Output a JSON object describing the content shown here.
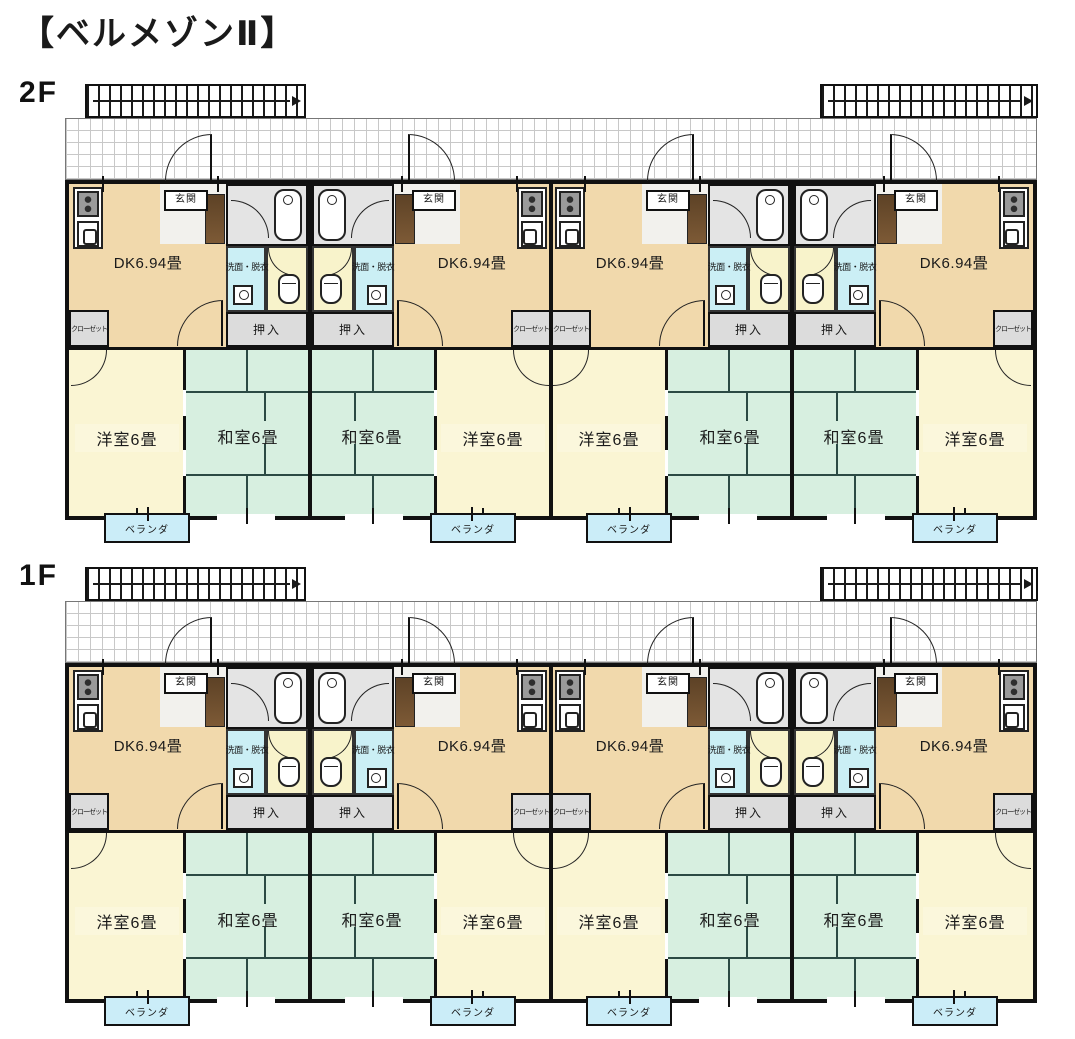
{
  "title": "【ベルメゾンⅡ】",
  "colors": {
    "dk_room": "#F1D9AC",
    "western_room": "#FAF5D3",
    "japanese_room": "#D7EFE0",
    "veranda": "#CBEDF8",
    "closet": "#DCDCDC",
    "bath": "#E4E4E4",
    "toilet_room": "#F8F3CB",
    "washroom": "#CBEFF5",
    "shoe_cabinet": "#7d5a36",
    "walls": "#111111"
  },
  "floors": [
    {
      "label": "2F",
      "units": [
        {
          "mirrored": false,
          "dk": "DK6.94畳",
          "entrance": "玄関",
          "washroom": "洗面・脱衣",
          "oshiire": "押入",
          "closet": "クローゼット",
          "western_room": "洋室6畳",
          "japanese_room": "和室6畳",
          "veranda": "ベランダ"
        },
        {
          "mirrored": true,
          "dk": "DK6.94畳",
          "entrance": "玄関",
          "washroom": "洗面・脱衣",
          "oshiire": "押入",
          "closet": "クローゼット",
          "western_room": "洋室6畳",
          "japanese_room": "和室6畳",
          "veranda": "ベランダ"
        },
        {
          "mirrored": false,
          "dk": "DK6.94畳",
          "entrance": "玄関",
          "washroom": "洗面・脱衣",
          "oshiire": "押入",
          "closet": "クローゼット",
          "western_room": "洋室6畳",
          "japanese_room": "和室6畳",
          "veranda": "ベランダ"
        },
        {
          "mirrored": true,
          "dk": "DK6.94畳",
          "entrance": "玄関",
          "washroom": "洗面・脱衣",
          "oshiire": "押入",
          "closet": "クローゼット",
          "western_room": "洋室6畳",
          "japanese_room": "和室6畳",
          "veranda": "ベランダ"
        }
      ]
    },
    {
      "label": "1F",
      "units": [
        {
          "mirrored": false,
          "dk": "DK6.94畳",
          "entrance": "玄関",
          "washroom": "洗面・脱衣",
          "oshiire": "押入",
          "closet": "クローゼット",
          "western_room": "洋室6畳",
          "japanese_room": "和室6畳",
          "veranda": "ベランダ"
        },
        {
          "mirrored": true,
          "dk": "DK6.94畳",
          "entrance": "玄関",
          "washroom": "洗面・脱衣",
          "oshiire": "押入",
          "closet": "クローゼット",
          "western_room": "洋室6畳",
          "japanese_room": "和室6畳",
          "veranda": "ベランダ"
        },
        {
          "mirrored": false,
          "dk": "DK6.94畳",
          "entrance": "玄関",
          "washroom": "洗面・脱衣",
          "oshiire": "押入",
          "closet": "クローゼット",
          "western_room": "洋室6畳",
          "japanese_room": "和室6畳",
          "veranda": "ベランダ"
        },
        {
          "mirrored": true,
          "dk": "DK6.94畳",
          "entrance": "玄関",
          "washroom": "洗面・脱衣",
          "oshiire": "押入",
          "closet": "クローゼット",
          "western_room": "洋室6畳",
          "japanese_room": "和室6畳",
          "veranda": "ベランダ"
        }
      ]
    }
  ]
}
